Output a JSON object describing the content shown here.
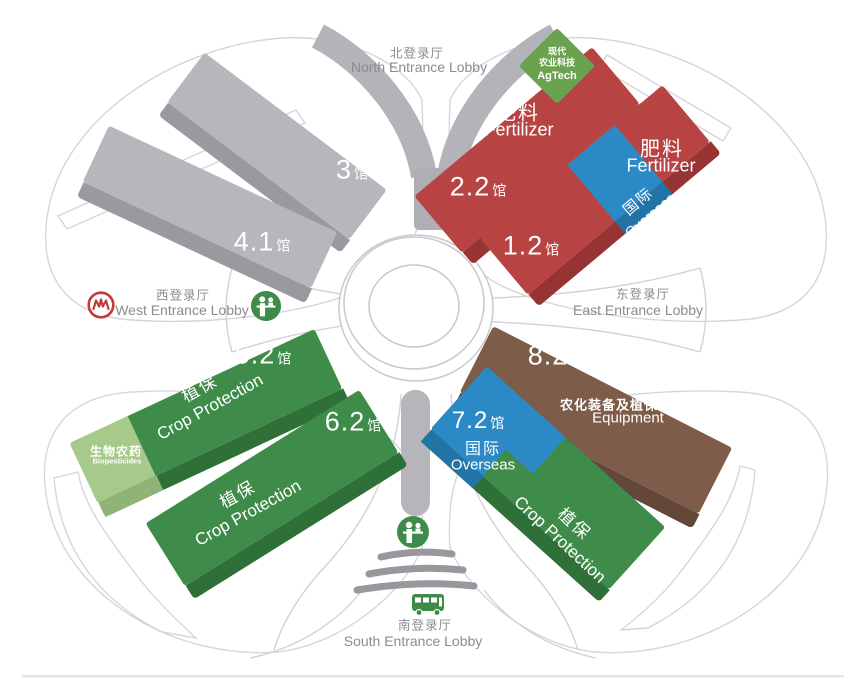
{
  "canvas": {
    "width": 844,
    "height": 682
  },
  "colors": {
    "hall_gray": "#b6b6bc",
    "hall_gray_side": "#999aa0",
    "hall_red": "#b84343",
    "hall_red_side": "#983333",
    "hall_green": "#3f8c4a",
    "hall_green_side": "#2f7038",
    "hall_blue": "#2b8ac5",
    "hall_blue_side": "#2273a6",
    "hall_brown": "#7d5c49",
    "hall_brown_side": "#63483a",
    "biopesticide_green": "#a7c989",
    "agtech_green": "#6aa24f",
    "outline": "#d5d5da",
    "funnel_gray": "#b3b3b9",
    "entrance_text": "#8b8b91",
    "metro_red": "#c23a3a",
    "icon_green": "#3f8c4a"
  },
  "entrances": {
    "north": {
      "cn": "北登录厅",
      "en": "North Entrance Lobby"
    },
    "west": {
      "cn": "西登录厅",
      "en": "West Entrance Lobby"
    },
    "east": {
      "cn": "东登录厅",
      "en": "East Entrance Lobby"
    },
    "south": {
      "cn": "南登录厅",
      "en": "South Entrance Lobby"
    }
  },
  "halls": [
    {
      "num": "3",
      "suffix": "馆"
    },
    {
      "num": "4.1",
      "suffix": "馆"
    },
    {
      "num": "2.2",
      "suffix": "馆",
      "cat_cn": "肥料",
      "cat_en": "Fertilizer"
    },
    {
      "num": "1.2",
      "suffix": "馆",
      "cat_cn": "肥料",
      "cat_en": "Fertilizer",
      "badge_cn": "国际",
      "badge_en": "Overseas"
    },
    {
      "num": "5.2",
      "suffix": "馆",
      "cat_cn": "植保",
      "cat_en": "Crop Protection",
      "badge_cn": "生物农药",
      "badge_en": "Biopesticides"
    },
    {
      "num": "6.2",
      "suffix": "馆",
      "cat_cn": "植保",
      "cat_en": "Crop Protection"
    },
    {
      "num": "7.2",
      "suffix": "馆",
      "cat_cn": "植保",
      "cat_en": "Crop Protection",
      "badge_cn": "国际",
      "badge_en": "Overseas"
    },
    {
      "num": "8.2",
      "suffix": "馆",
      "cat_cn": "农化装备及植保器械",
      "cat_en": "Equipment"
    }
  ],
  "agtech": {
    "line1": "现代",
    "line2": "农业科技",
    "line3": "AgTech"
  },
  "icons": {
    "metro": "shanghai-metro-logo",
    "registration": "registration-desk",
    "bus": "shuttle-bus"
  }
}
